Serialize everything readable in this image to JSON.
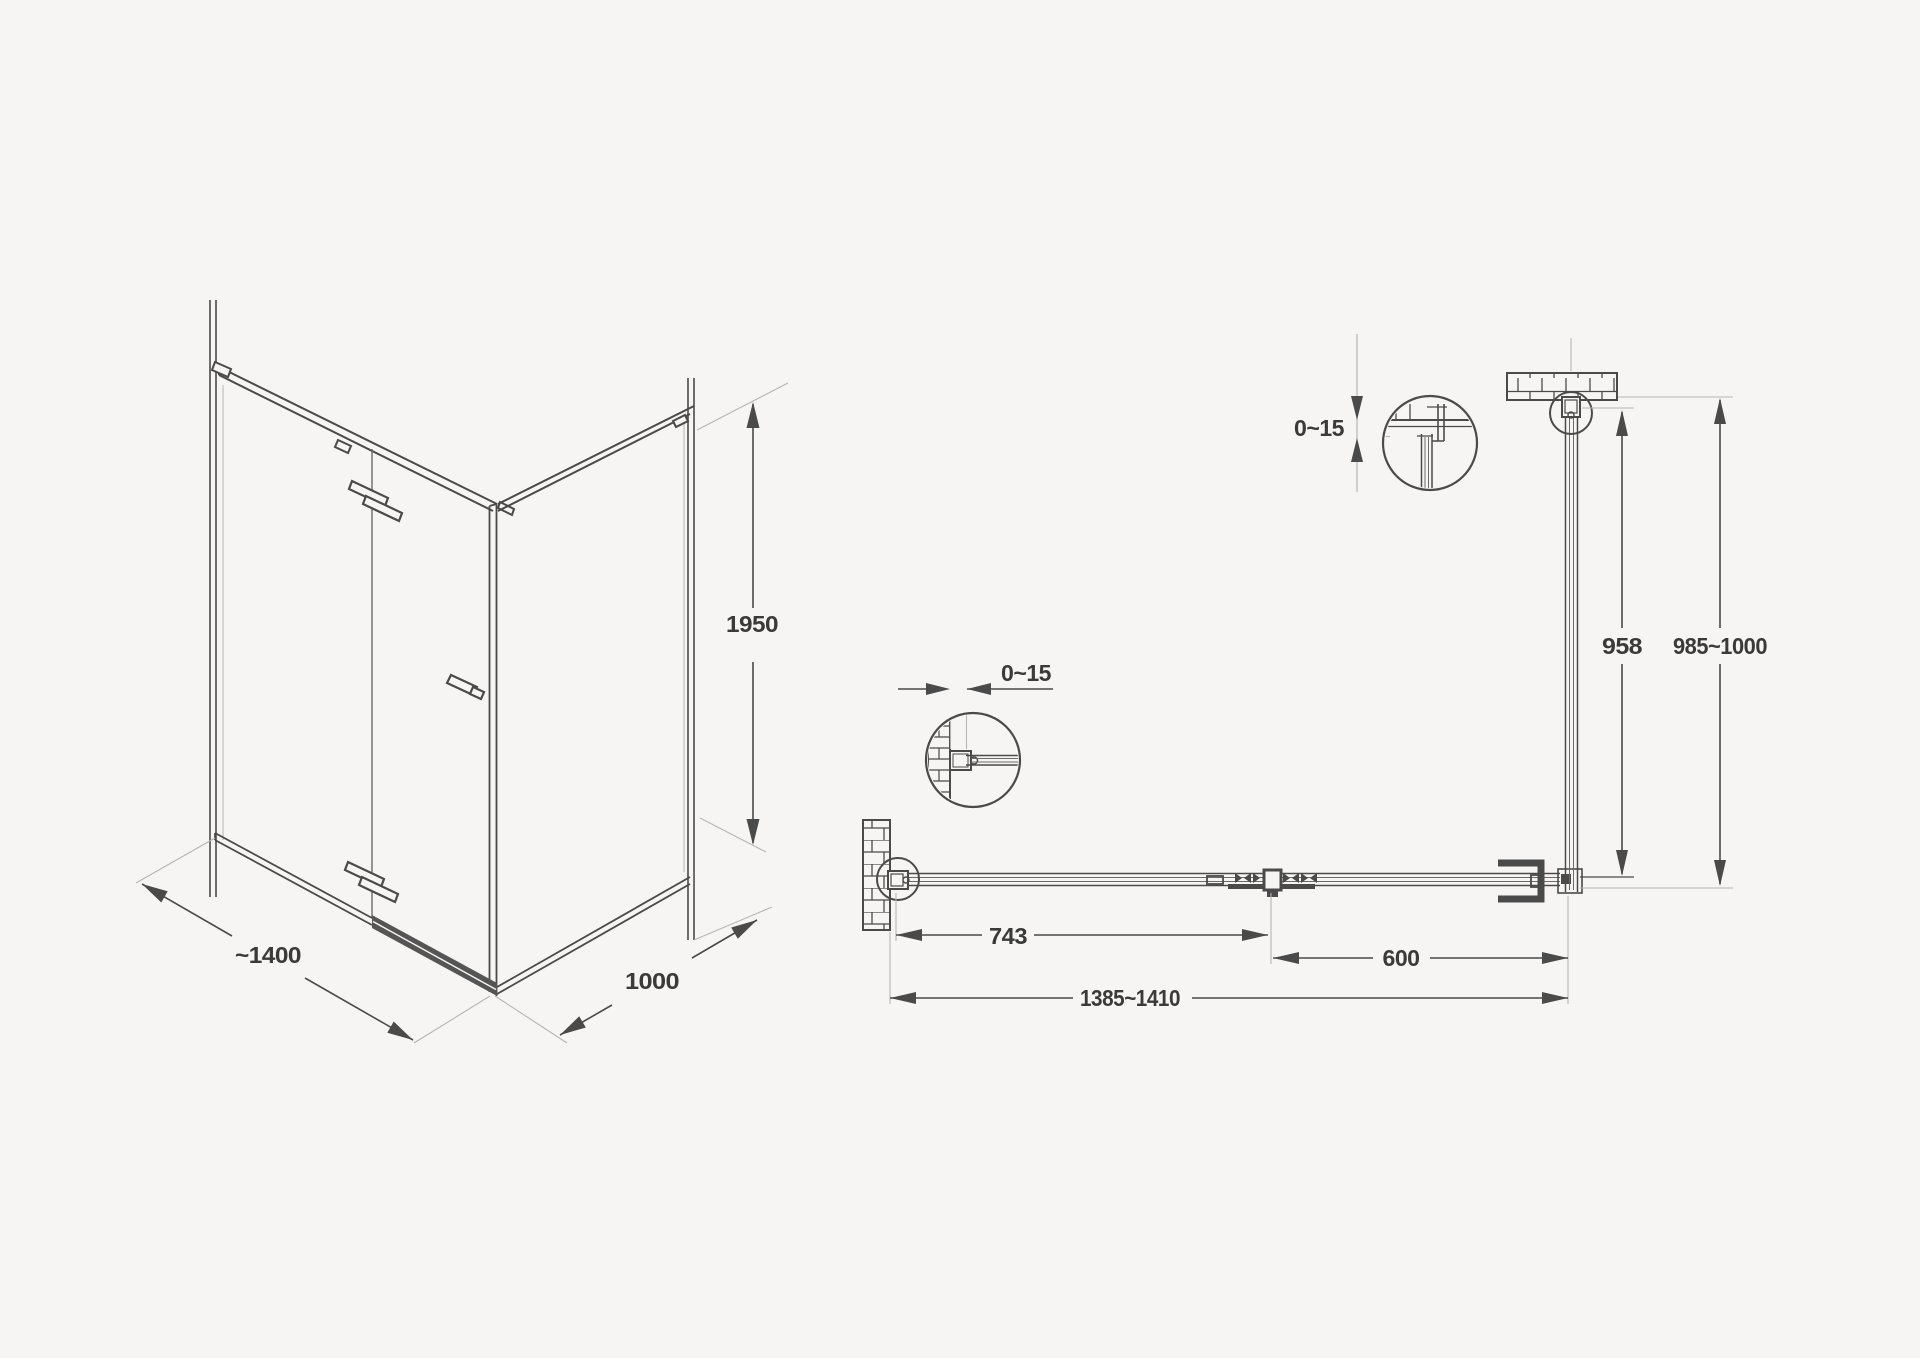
{
  "drawing": {
    "type": "shower-enclosure-technical-drawing",
    "background_color": "#f6f5f3",
    "line_color": "#4a4a4a",
    "text_color": "#3a3a3a",
    "extension_line_color": "#b5b5b5",
    "views": {
      "iso_view": "corner shower enclosure with hinged door, isometric",
      "plan_view": "top plan section with wall fixing details"
    },
    "labels": {
      "iso": {
        "width": "~1400",
        "depth": "1000",
        "height": "1950"
      },
      "plan": {
        "door_width": "743",
        "side_panel_width": "600",
        "total_width": "1385~1410",
        "depth_inner": "958",
        "depth_total": "985~1000",
        "gap_left": "0~15",
        "gap_top": "0~15"
      }
    }
  }
}
